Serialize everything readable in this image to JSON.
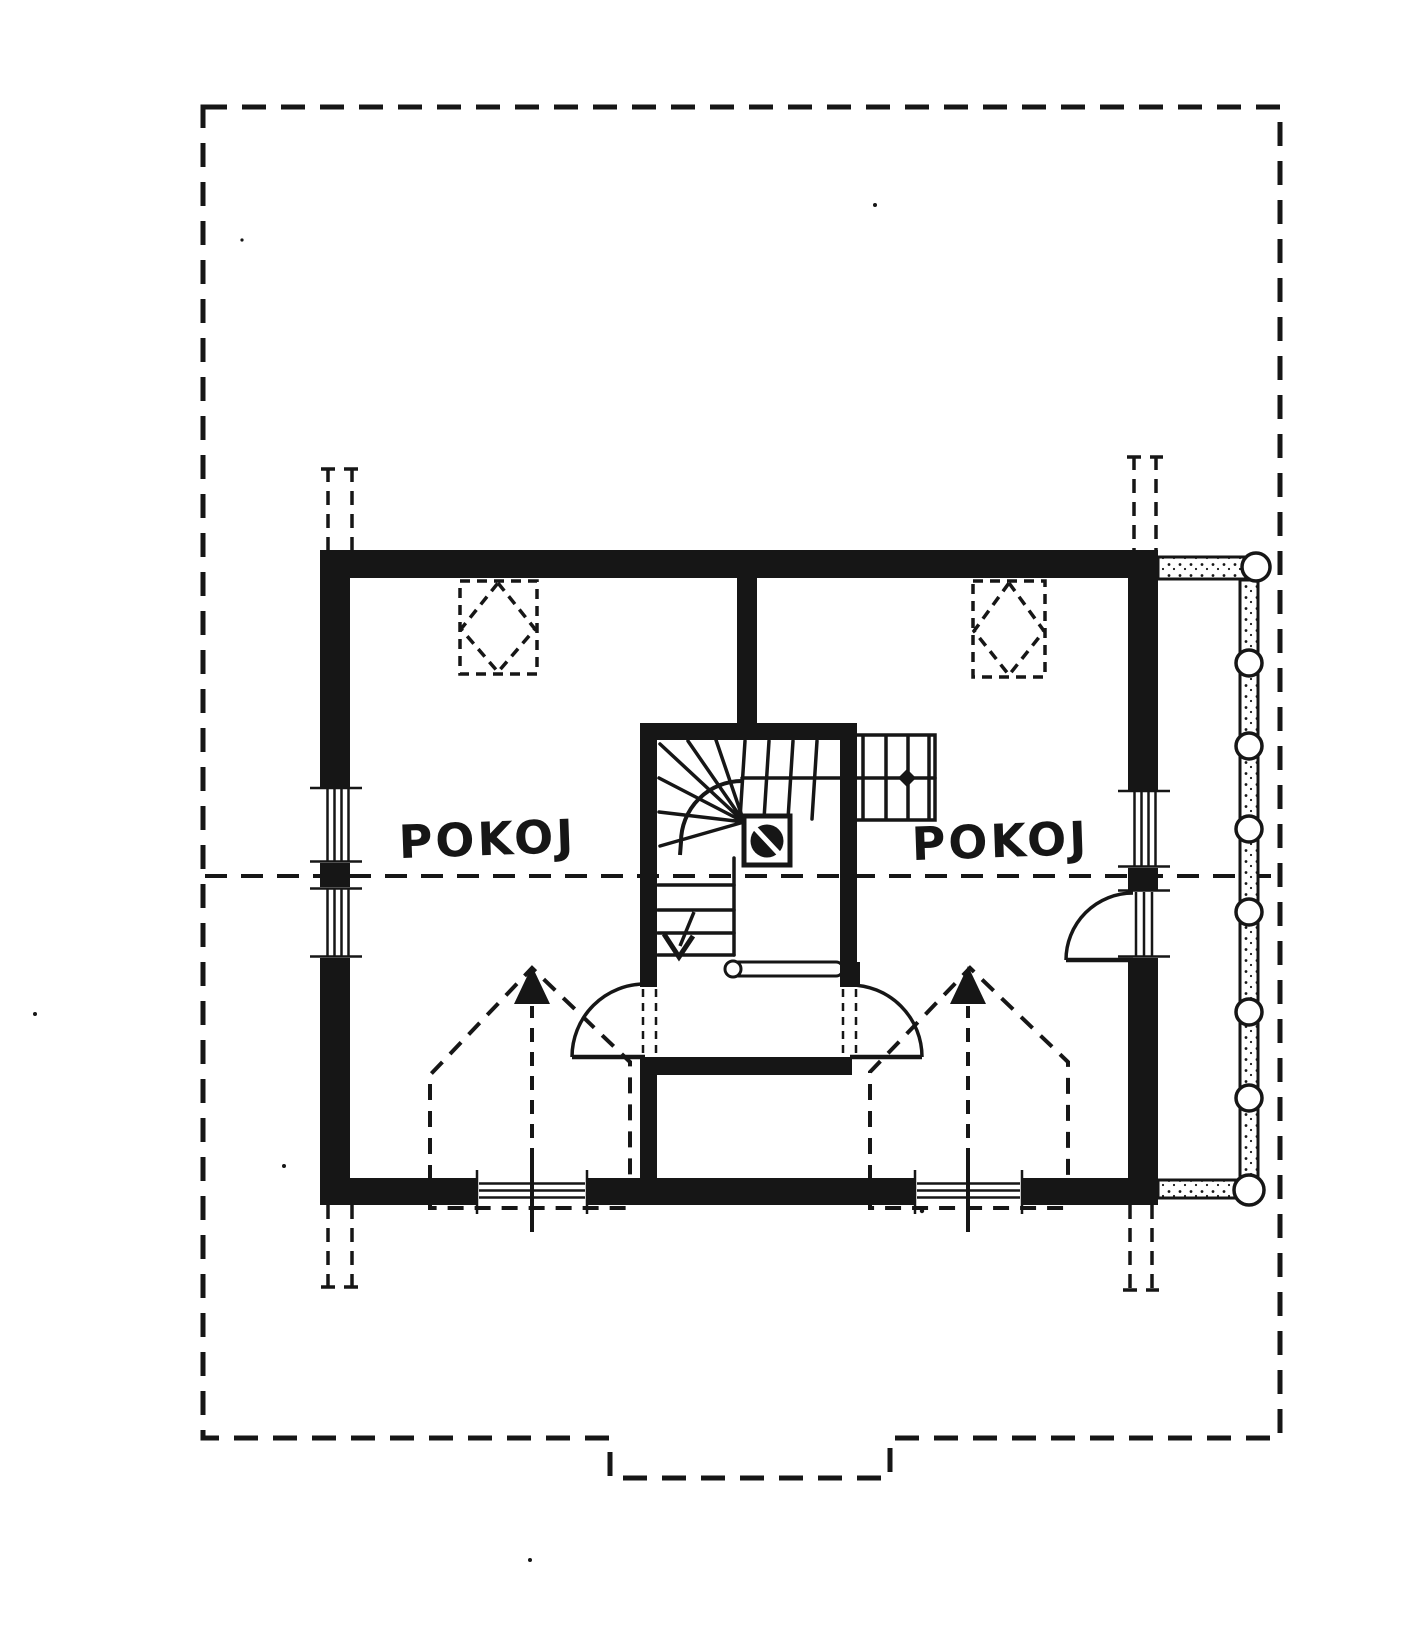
{
  "plan": {
    "kind": "hand-drawn attic floor plan",
    "paper_color": "#ffffff",
    "ink_color": "#161616",
    "rooms": [
      {
        "label": "POKOJ"
      },
      {
        "label": "POKOJ"
      }
    ],
    "icons": [
      "roof-outline-dashed-icon",
      "section-dashed-line-icon",
      "roof-window-diamond-icon",
      "dormer-arrow-icon",
      "chimney-stub-dashed-icon",
      "winder-stair-icon",
      "stair-down-arrow-icon",
      "flue-square-circle-icon",
      "door-swing-arc-icon",
      "window-hatch-icon",
      "log-balcony-railing-icon"
    ]
  }
}
